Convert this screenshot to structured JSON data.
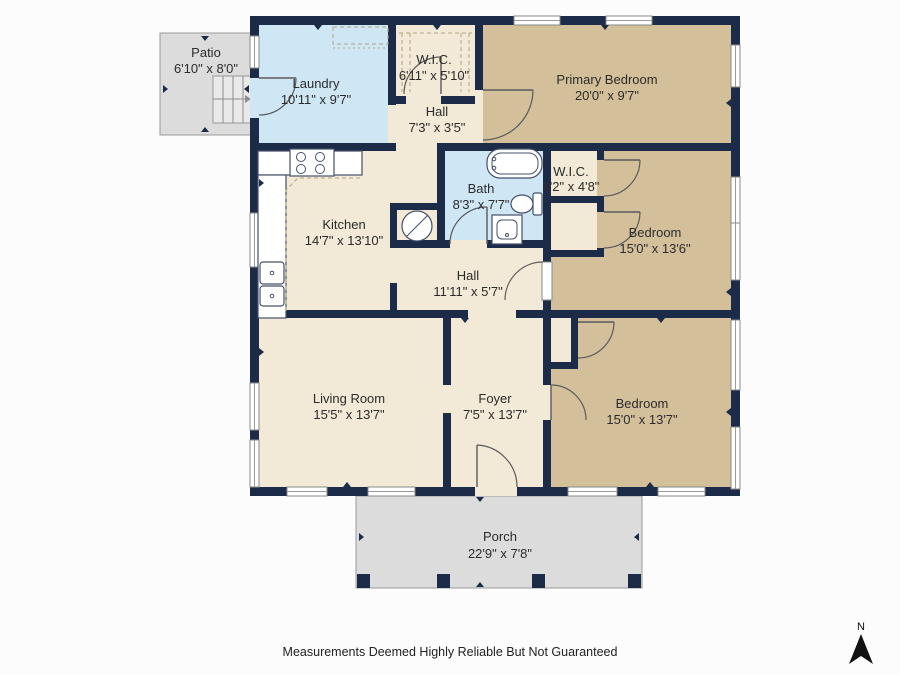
{
  "colors": {
    "wall": "#1c2b47",
    "floor_cream": "#f2e9d6",
    "floor_tan": "#d4bf9b",
    "floor_blue": "#cfe7f5",
    "outdoor": "#dcdcdc",
    "outdoor_border": "#9a9a9a",
    "arc": "#5a5a5a",
    "fixture": "#44506a",
    "dash": "#b3a585",
    "label": "#2b2b2b"
  },
  "rooms": {
    "patio": {
      "name": "Patio",
      "dims": "6'10\" x 8'0\""
    },
    "laundry": {
      "name": "Laundry",
      "dims": "10'11\" x 9'7\""
    },
    "wic_top": {
      "name": "W.I.C.",
      "dims": "6'11\" x 5'10\""
    },
    "hall_top": {
      "name": "Hall",
      "dims": "7'3\" x 3'5\""
    },
    "primary_bedroom": {
      "name": "Primary Bedroom",
      "dims": "20'0\" x 9'7\""
    },
    "bath": {
      "name": "Bath",
      "dims": "8'3\" x 7'7\""
    },
    "wic_mid": {
      "name": "W.I.C.",
      "dims": "4'2\" x 4'8\""
    },
    "kitchen": {
      "name": "Kitchen",
      "dims": "14'7\" x 13'10\""
    },
    "bedroom_mid": {
      "name": "Bedroom",
      "dims": "15'0\" x 13'6\""
    },
    "hall_mid": {
      "name": "Hall",
      "dims": "11'11\" x 5'7\""
    },
    "living_room": {
      "name": "Living Room",
      "dims": "15'5\" x 13'7\""
    },
    "foyer": {
      "name": "Foyer",
      "dims": "7'5\" x 13'7\""
    },
    "bedroom_bottom": {
      "name": "Bedroom",
      "dims": "15'0\" x 13'7\""
    },
    "porch": {
      "name": "Porch",
      "dims": "22'9\" x 7'8\""
    }
  },
  "footer": {
    "disclaimer": "Measurements Deemed Highly Reliable But Not Guaranteed"
  },
  "compass": {
    "label": "N"
  }
}
